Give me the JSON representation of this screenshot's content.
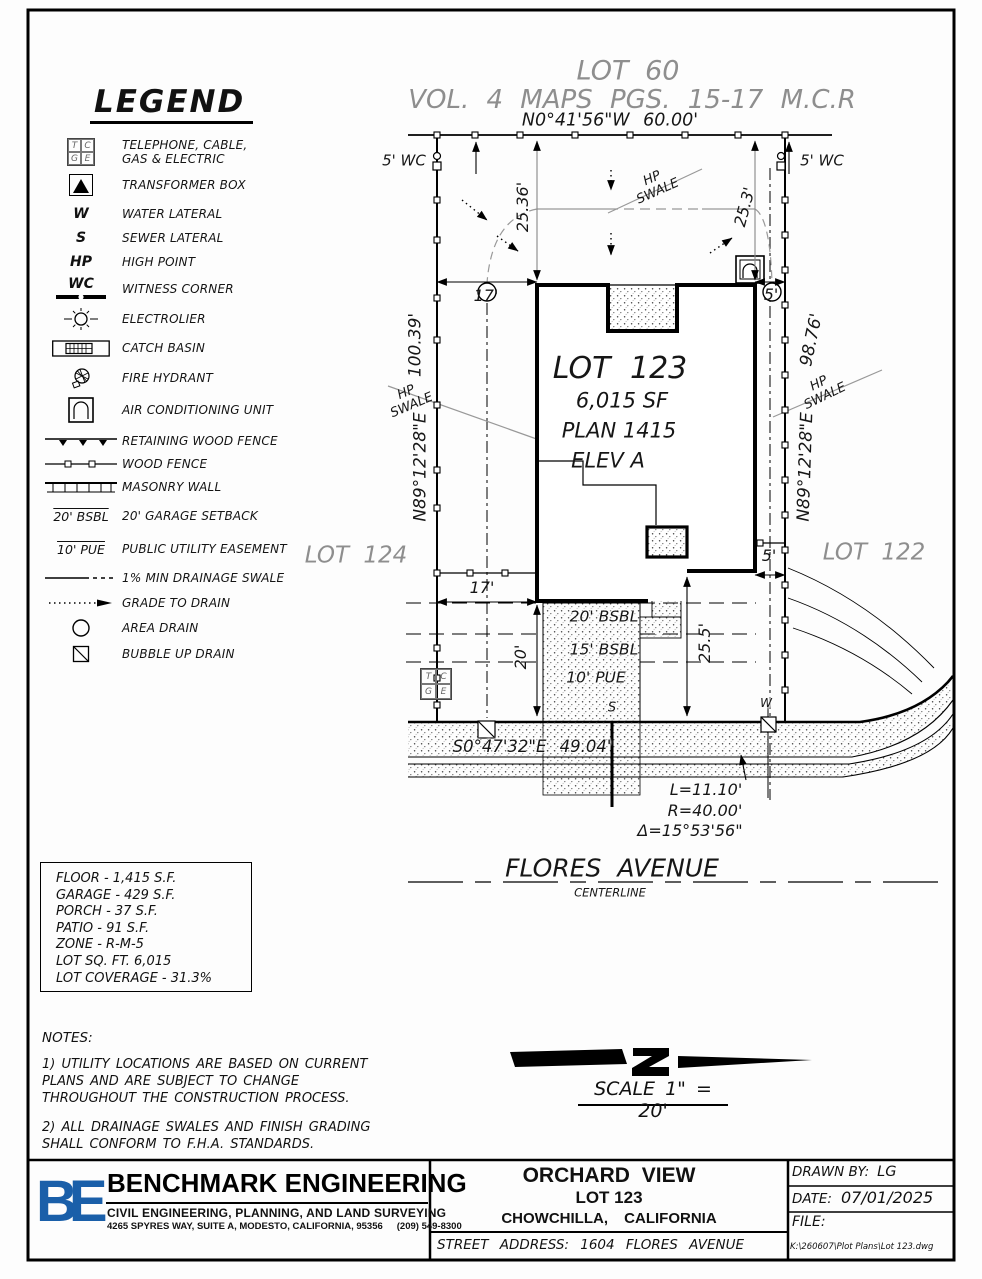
{
  "header": {
    "lot": "LOT 60",
    "vol": "VOL. 4 MAPS PGS. 15-17 M.C.R"
  },
  "legend": {
    "title": "LEGEND",
    "tcge": {
      "t": "T",
      "c": "C",
      "g": "G",
      "e": "E"
    },
    "items": [
      {
        "label": "TELEPHONE, CABLE, GAS & ELECTRIC"
      },
      {
        "label": "TRANSFORMER BOX"
      },
      {
        "sym": "W",
        "label": "WATER LATERAL"
      },
      {
        "sym": "S",
        "label": "SEWER LATERAL"
      },
      {
        "sym": "HP",
        "label": "HIGH POINT"
      },
      {
        "sym": "WC",
        "label": "WITNESS CORNER"
      },
      {
        "label": "ELECTROLIER"
      },
      {
        "label": "CATCH BASIN"
      },
      {
        "label": "FIRE HYDRANT"
      },
      {
        "label": "AIR CONDITIONING UNIT"
      },
      {
        "label": "RETAINING WOOD FENCE"
      },
      {
        "label": "WOOD FENCE"
      },
      {
        "label": "MASONRY WALL"
      },
      {
        "sym": "20' BSBL",
        "label": "20' GARAGE SETBACK"
      },
      {
        "sym": "10' PUE",
        "label": "PUBLIC UTILITY EASEMENT"
      },
      {
        "label": "1% MIN DRAINAGE SWALE"
      },
      {
        "label": "GRADE TO DRAIN"
      },
      {
        "label": "AREA DRAIN"
      },
      {
        "label": "BUBBLE UP DRAIN"
      }
    ]
  },
  "plan": {
    "north_bearing": "N0°41'56\"W  60.00'",
    "wc_left": "5' WC",
    "wc_right": "5' WC",
    "dim_west": "100.39'",
    "dim_east": "98.76'",
    "bearing_west": "N89°12'28\"E",
    "bearing_east": "N89°12'28\"E",
    "hp": "HP",
    "swale": "SWALE",
    "lot_west": "LOT 124",
    "lot_east": "LOT 122",
    "lot_name": "LOT 123",
    "lot_area": "6,015 SF",
    "lot_plan": "PLAN 1415",
    "lot_elev": "ELEV A",
    "dim_rear_west": "25.36'",
    "dim_rear_east": "25.3'",
    "dim_side_west_top": "17'",
    "dim_side_west_bot": "17'",
    "dim_side_east_top": "5'",
    "dim_side_east_bot": "5'",
    "dim_front": "20'",
    "dim_front_east": "25.5'",
    "setback_20": "20' BSBL",
    "setback_15": "15' BSBL",
    "pue_10": "10' PUE",
    "sewer": "S",
    "water": "W",
    "front_bearing": "S0°47'32\"E  49.04'",
    "curve_l": "L=11.10'",
    "curve_r": "R=40.00'",
    "curve_d": "Δ=15°53'56\"",
    "street": "FLORES AVENUE",
    "centerline": "CENTERLINE"
  },
  "summary": {
    "rows": [
      "FLOOR - 1,415 S.F.",
      "GARAGE - 429 S.F.",
      "PORCH - 37 S.F.",
      "PATIO - 91 S.F.",
      "ZONE - R-M-5",
      "LOT SQ. FT. 6,015",
      "LOT COVERAGE - 31.3%"
    ]
  },
  "notes": {
    "title": "NOTES:",
    "n1": "1) UTILITY LOCATIONS ARE BASED ON CURRENT PLANS AND ARE SUBJECT TO CHANGE THROUGHOUT THE CONSTRUCTION PROCESS.",
    "n2": "2) ALL DRAINAGE SWALES AND FINISH GRADING SHALL CONFORM TO F.H.A. STANDARDS."
  },
  "scale": {
    "label": "SCALE 1\" = 20'"
  },
  "titleblock": {
    "logo": "BE",
    "company": "BENCHMARK ENGINEERING",
    "services": "CIVIL ENGINEERING, PLANNING, AND LAND SURVEYING",
    "address": "4265 SPYRES WAY, SUITE A, MODESTO, CALIFORNIA, 95356",
    "phone": "(209) 549-8300",
    "project": "ORCHARD VIEW",
    "lot": "LOT 123",
    "city": "CHOWCHILLA, CALIFORNIA",
    "street_address": "STREET ADDRESS: 1604 FLORES AVENUE",
    "drawn_label": "DRAWN BY:",
    "drawn_value": "LG",
    "date_label": "DATE:",
    "date_value": "07/01/2025",
    "file_label": "FILE:",
    "file_path": "K:\\260607\\Plot Plans\\Lot 123.dwg"
  },
  "colors": {
    "accent_blue": "#1a5fa9",
    "gray_text": "#8e8e8e",
    "line": "#000000"
  }
}
